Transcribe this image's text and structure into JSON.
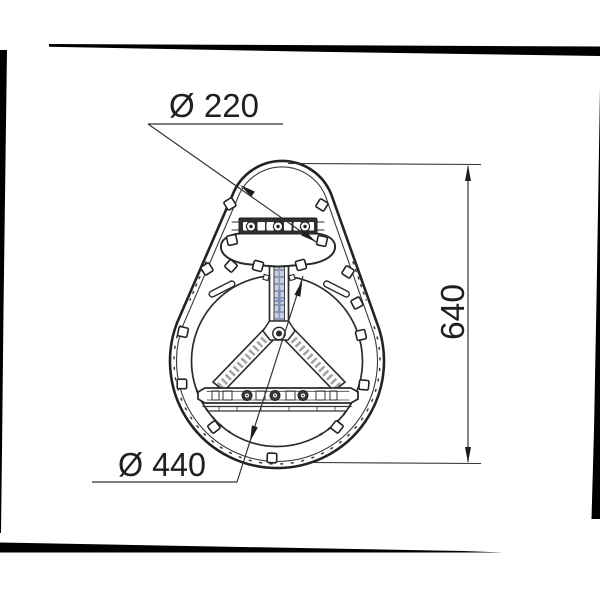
{
  "drawing": {
    "type": "technical-dimension-drawing",
    "dimensions": {
      "top_diameter": "Ø 220",
      "bottom_diameter": "Ø 440",
      "height": "640"
    },
    "colors": {
      "line": "#2b2b2b",
      "text": "#1f1f1f",
      "dimension_line": "#333333",
      "stem_tint": "#c9cfe3",
      "stem_accent": "#7d8cb8",
      "scan_border": "#000000",
      "background": "#ffffff"
    }
  }
}
